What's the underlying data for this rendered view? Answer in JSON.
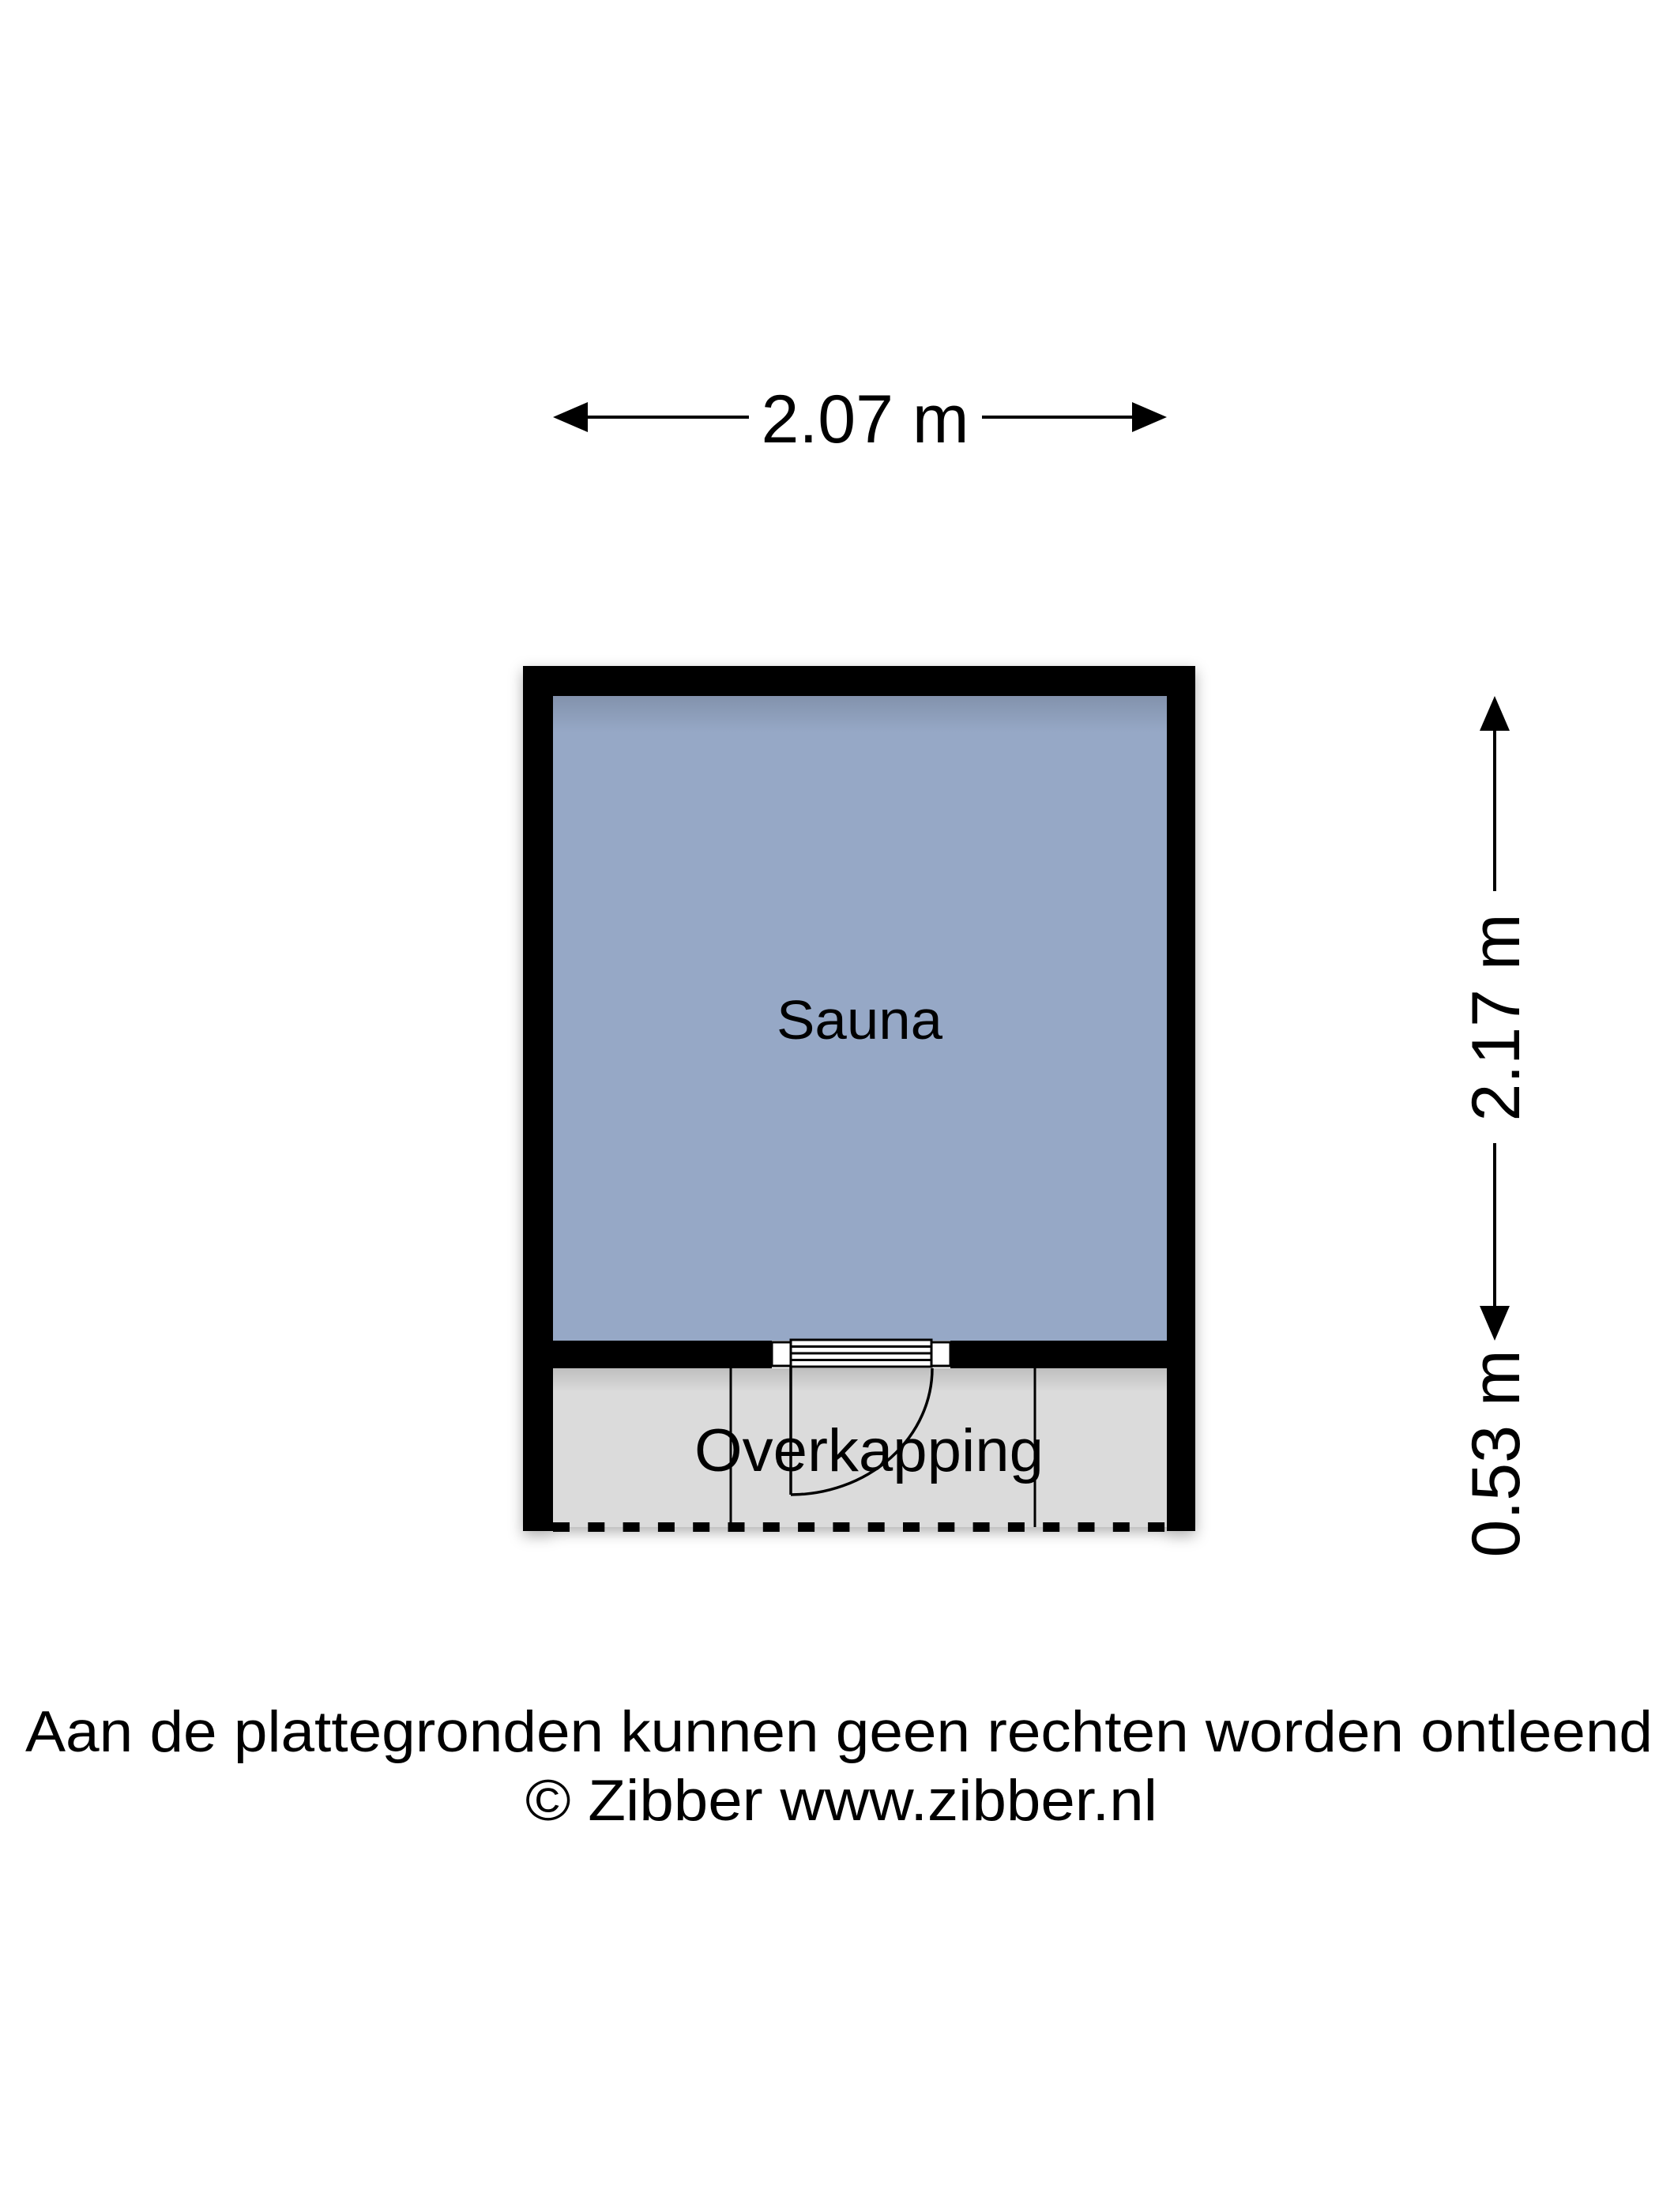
{
  "plan": {
    "rooms": [
      {
        "label": "Sauna"
      },
      {
        "label": "Overkapping"
      }
    ],
    "dimensions": {
      "width": "2.07 m",
      "height": "2.17 m",
      "depth": "0.53 m"
    },
    "colors": {
      "wall": "#000000",
      "sauna_fill": "#96A8C6",
      "overkapping_fill": "#DBDBDB",
      "background": "#FFFFFF"
    }
  },
  "footer": {
    "disclaimer": "Aan de plattegronden kunnen geen rechten worden ontleend",
    "credit": "© Zibber www.zibber.nl"
  }
}
